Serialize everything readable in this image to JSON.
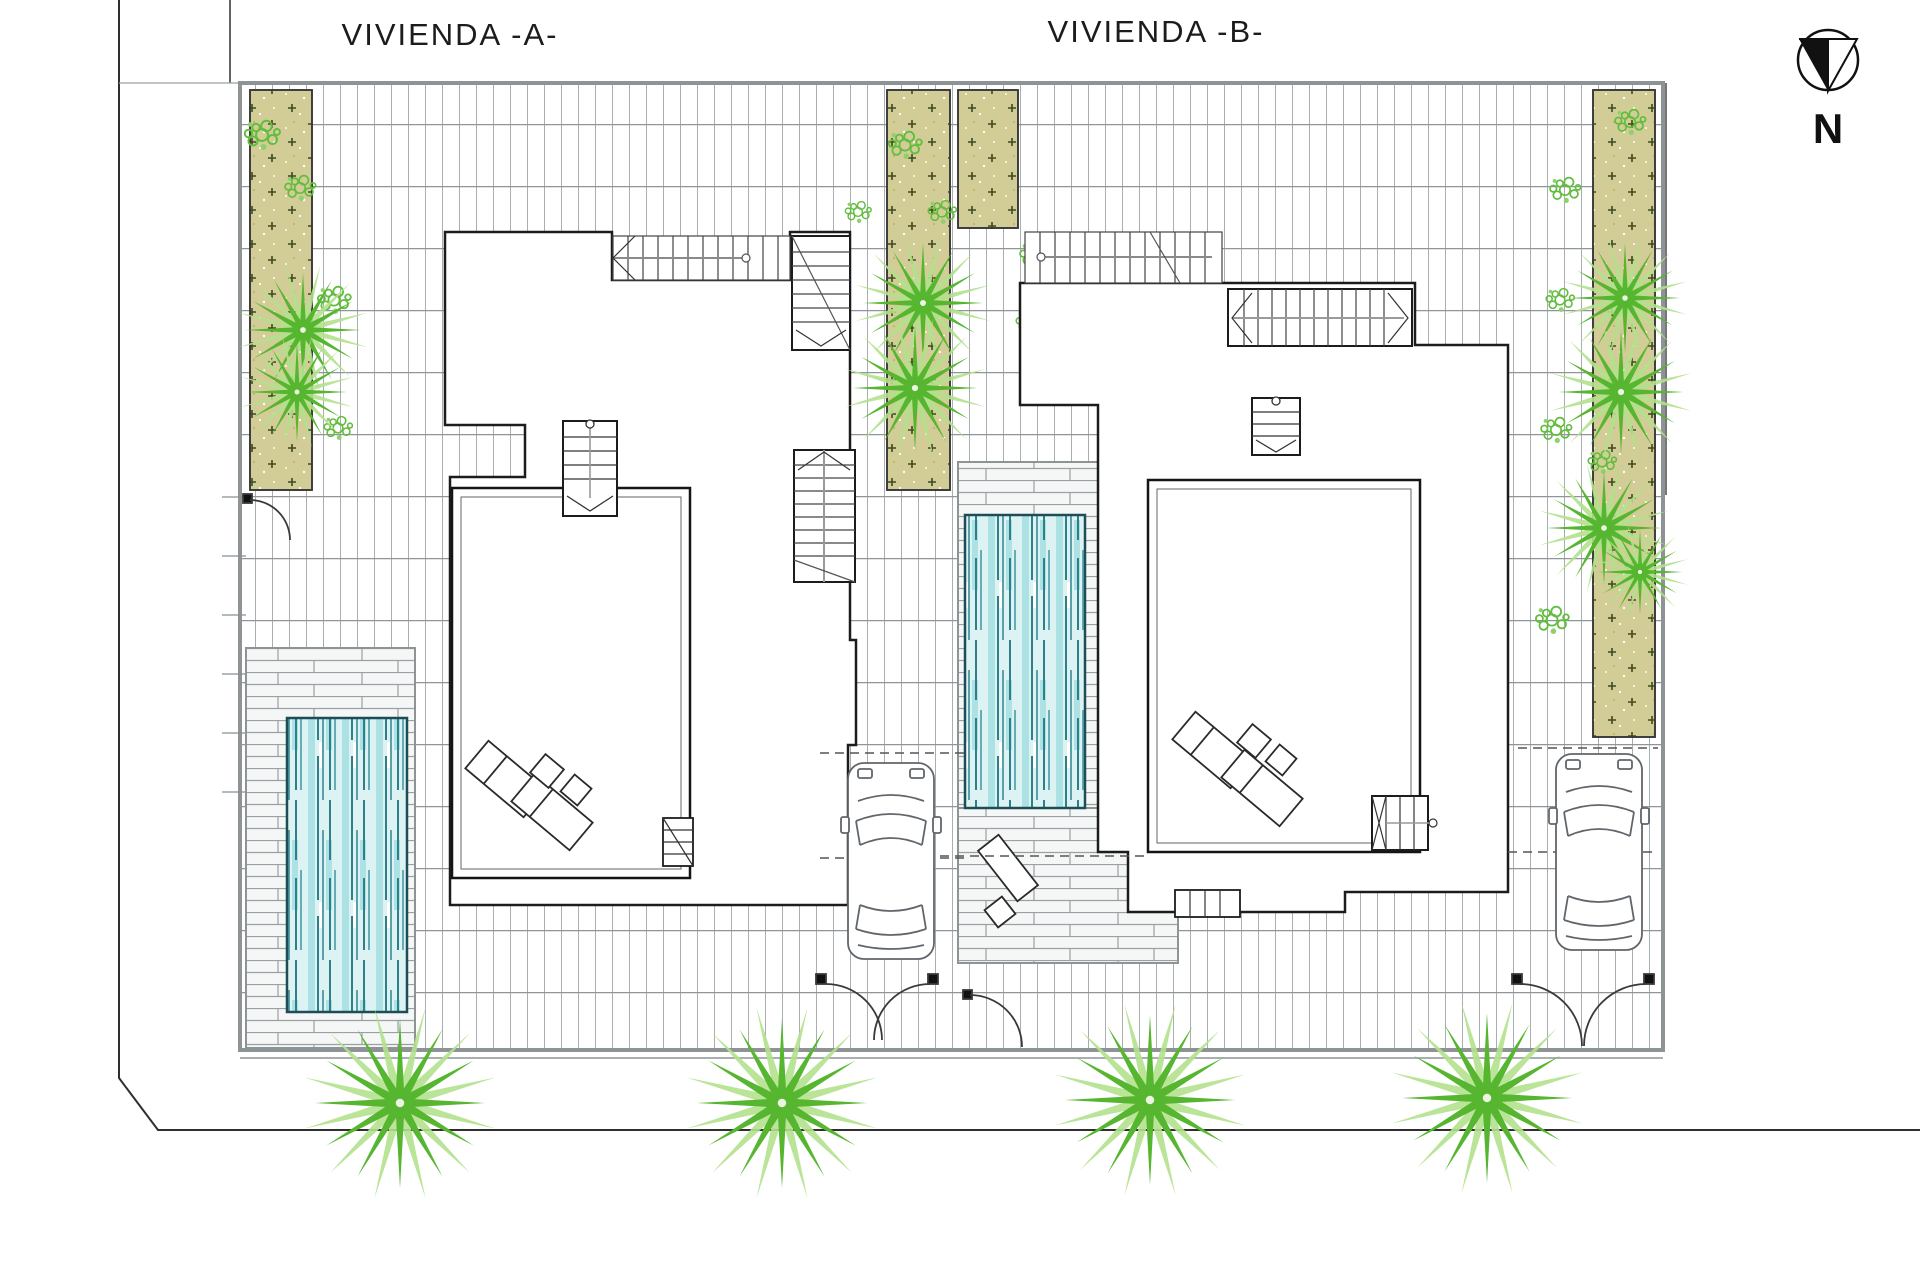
{
  "labels": {
    "dwelling_a": "VIVIENDA -A-",
    "dwelling_b": "VIVIENDA -B-"
  },
  "compass": {
    "label": "N"
  },
  "colors": {
    "pool_fill": "#ddf3f3",
    "pool_stripe_dark": "#2f7f8b",
    "pool_stripe_light": "#ade2e4",
    "garden_fill": "#d2cc96",
    "palm_green": "#56b62f",
    "palm_green_light": "#b2e18c",
    "tile_line": "#a9aeb1",
    "site_border": "#8e9396",
    "outline": "#1c1c1c"
  },
  "site": {
    "dwellings": [
      {
        "id": "A",
        "features": [
          "roof-plan",
          "terrace",
          "stairs",
          "pool",
          "timber-deck",
          "sun-loungers",
          "car",
          "driveway-gate"
        ]
      },
      {
        "id": "B",
        "features": [
          "roof-plan",
          "terrace",
          "stairs",
          "pool",
          "timber-deck",
          "sun-loungers",
          "car",
          "driveway-gate",
          "pedestrian-gate"
        ]
      }
    ],
    "garden_strip_count": 4,
    "street_palm_count": 4,
    "orientation": "north-down"
  }
}
